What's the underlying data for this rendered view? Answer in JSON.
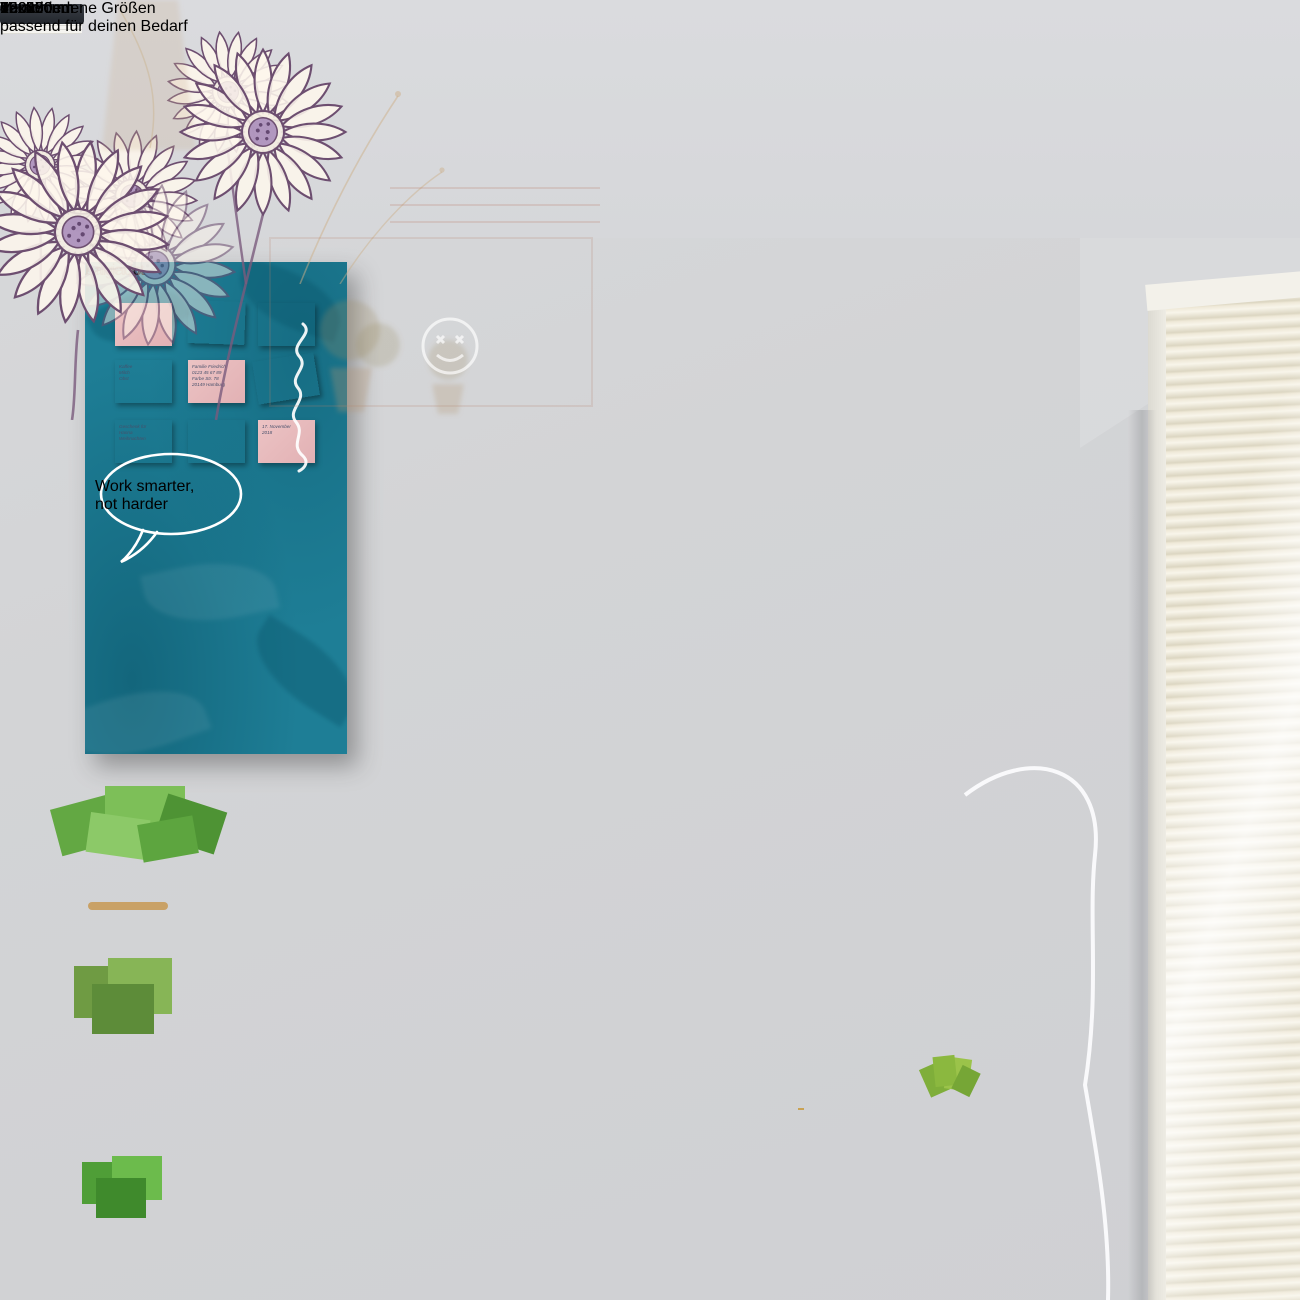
{
  "banner": {
    "title": "Verschiedene Größen",
    "subtitle": "passend für deinen Bedarf"
  },
  "sizes": [
    "45x30cm",
    "60x40cm",
    "75x50cm",
    "90x60cm",
    "100x50cm",
    "100x70cm",
    "120x60cm",
    "120x80cm",
    "120x90cm"
  ],
  "colors": {
    "banner_green": "#7aac4e",
    "size_text_green": "#7cb254",
    "board_teal": "#1e7e96",
    "eu_badge_blue": "#2e6fb7",
    "star_yellow": "#f7d832",
    "brand_green": "#74a646",
    "cork_magnet": "#a67a50"
  },
  "teal_board": {
    "speech_bubble": {
      "line1": "Work smarter,",
      "line2": "not harder"
    },
    "notes": [
      {
        "color": "pink",
        "text": ""
      },
      {
        "color": "yellow",
        "text": ""
      },
      {
        "color": "blue",
        "text": ""
      },
      {
        "color": "blue",
        "text": "Kaffee\nMilch\nObst"
      },
      {
        "color": "pink",
        "text": "Familie Friedrich\n0123 45 67 89\nFarbe Str. 78\n20149 Hamburg"
      },
      {
        "color": "yellow",
        "text": ""
      },
      {
        "color": "yellow",
        "text": "Geschenk für\nHanna\nWeihnachten"
      },
      {
        "color": "blue",
        "text": ""
      },
      {
        "color": "pink",
        "text": "17. November\n2018"
      }
    ],
    "invoice": {
      "title": "Angebot",
      "brand": "banjado"
    }
  },
  "memo_board": {
    "badge": {
      "line1": "MADE IN",
      "line2": "EUROPE"
    },
    "label": {
      "brand": "banjado",
      "danke": "DANKE!!"
    },
    "handwriting": {
      "line1": "Termine:",
      "line2": "12:30 Uhr Teammeeting",
      "line3": "14:00 Uhr Gespräch mit Chefin",
      "reminder1": "Kuchen",
      "reminder2": "nicht vergessen"
    }
  }
}
